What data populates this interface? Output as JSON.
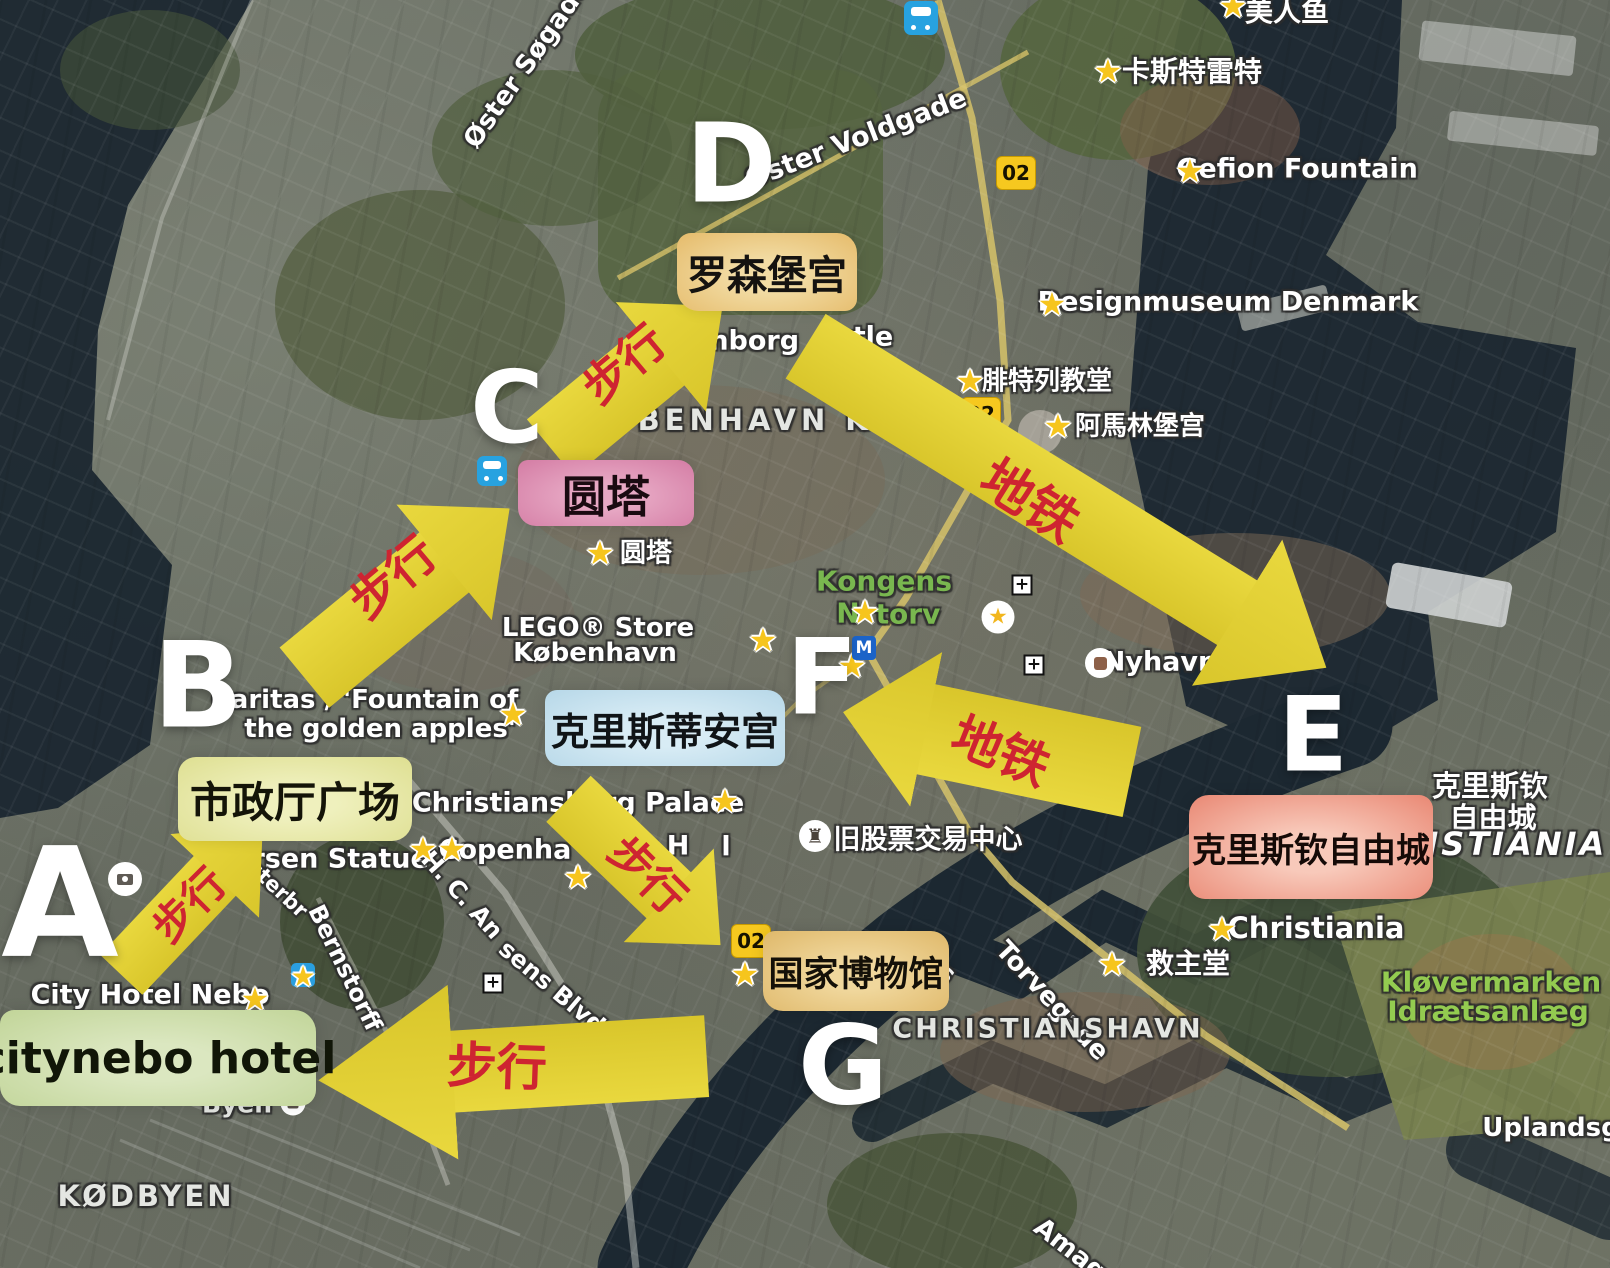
{
  "colors": {
    "arrow_yellow": "#e2cf32",
    "arrow_text_red": "#ce2431",
    "letter_white": "#ffffff",
    "map_label_green": "#79b74f",
    "park_label_green": "#93cb50",
    "water": "#1c2831",
    "star_yellow": "#f6c51d"
  },
  "letters": [
    {
      "label": "A",
      "x": 60,
      "y": 910,
      "fs": 152
    },
    {
      "label": "B",
      "x": 198,
      "y": 692,
      "fs": 119
    },
    {
      "label": "C",
      "x": 507,
      "y": 412,
      "fs": 100
    },
    {
      "label": "D",
      "x": 731,
      "y": 168,
      "fs": 110
    },
    {
      "label": "E",
      "x": 1313,
      "y": 740,
      "fs": 103
    },
    {
      "label": "F",
      "x": 822,
      "y": 682,
      "fs": 105
    },
    {
      "label": "G",
      "x": 843,
      "y": 1070,
      "fs": 110
    }
  ],
  "boxes": [
    {
      "name": "rosenborg-castle-label",
      "text": "罗森堡宫",
      "x": 767,
      "y": 272,
      "w": 180,
      "h": 78,
      "bg": "#e6bd6e",
      "bg2": "#f2dca4",
      "fg": "#151310",
      "fs": 40,
      "rad": "14px 20px 12px 22px"
    },
    {
      "name": "round-tower-label",
      "text": "圆塔",
      "x": 606,
      "y": 493,
      "w": 176,
      "h": 66,
      "bg": "#d57fa6",
      "bg2": "#e7a8c4",
      "fg": "#1a0a11",
      "fs": 44,
      "rad": "10px 16px 12px 18px"
    },
    {
      "name": "christiansborg-palace-label",
      "text": "克里斯蒂安宫",
      "x": 665,
      "y": 728,
      "w": 240,
      "h": 76,
      "bg": "#b9d9e9",
      "bg2": "#d8ecf5",
      "fg": "#101417",
      "fs": 38,
      "rad": "12px 18px 10px 16px"
    },
    {
      "name": "city-hall-square-label",
      "text": "市政厅广场",
      "x": 295,
      "y": 799,
      "w": 234,
      "h": 84,
      "bg": "#dfe094",
      "bg2": "#eff0bd",
      "fg": "#141408",
      "fs": 42,
      "rad": "18px 12px 20px 14px"
    },
    {
      "name": "citynebo-hotel-label",
      "text": "citynebo hotel",
      "x": 158,
      "y": 1058,
      "w": 316,
      "h": 96,
      "bg": "#c3d69b",
      "bg2": "#dbe7c0",
      "fg": "#111608",
      "fs": 44,
      "rad": "14px 22px 16px 20px"
    },
    {
      "name": "christiania-freetown-label",
      "text": "克里斯钦自由城",
      "x": 1311,
      "y": 847,
      "w": 244,
      "h": 104,
      "bg": "#ea8c78",
      "bg2": "#f8c9ba",
      "fg": "#150a07",
      "fs": 34,
      "rad": "20px 14px 22px 16px"
    },
    {
      "name": "national-museum-label",
      "text": "国家博物馆",
      "x": 856,
      "y": 971,
      "w": 186,
      "h": 80,
      "bg": "#e0ba6d",
      "bg2": "#f0d79c",
      "fg": "#141008",
      "fs": 35,
      "rad": "12px 18px 14px 20px"
    }
  ],
  "arrows": [
    {
      "name": "arrow-walk-a-b",
      "label": "步行",
      "cx": 192,
      "cy": 900,
      "len": 206,
      "ang": -46.6,
      "shaft": 58,
      "headL": 70,
      "headW": 122,
      "tx": 187,
      "ty": 903,
      "trot": -45,
      "tfs": 42
    },
    {
      "name": "arrow-walk-b-c",
      "label": "步行",
      "cx": 407,
      "cy": 593,
      "len": 266,
      "ang": -39.5,
      "shaft": 78,
      "headL": 85,
      "headW": 150,
      "tx": 390,
      "ty": 574,
      "trot": -40,
      "tfs": 48
    },
    {
      "name": "arrow-walk-c-d",
      "label": "步行",
      "cx": 636,
      "cy": 377,
      "len": 223,
      "ang": -39.5,
      "shaft": 74,
      "headL": 80,
      "headW": 142,
      "tx": 622,
      "ty": 362,
      "trot": -40,
      "tfs": 46
    },
    {
      "name": "arrow-metro-d-e",
      "label": "地铁",
      "cx": 1066,
      "cy": 507,
      "len": 612,
      "ang": 31.7,
      "shaft": 76,
      "headL": 105,
      "headW": 172,
      "tx": 1032,
      "ty": 497,
      "trot": 32,
      "tfs": 52
    },
    {
      "name": "arrow-metro-e-f",
      "label": "地铁",
      "cx": 987,
      "cy": 742,
      "len": 295,
      "ang": -168.3,
      "shaft": 92,
      "headL": 85,
      "headW": 158,
      "tx": 1002,
      "ty": 748,
      "trot": 22,
      "tfs": 50
    },
    {
      "name": "arrow-walk-f-g",
      "label": "步行",
      "cx": 644,
      "cy": 872,
      "len": 211,
      "ang": 43.9,
      "shaft": 64,
      "headL": 72,
      "headW": 130,
      "tx": 650,
      "ty": 872,
      "trot": 45,
      "tfs": 44
    },
    {
      "name": "arrow-walk-g-a",
      "label": "步行",
      "cx": 512,
      "cy": 1068,
      "len": 389,
      "ang": 176.5,
      "shaft": 82,
      "headL": 135,
      "headW": 175,
      "tx": 497,
      "ty": 1063,
      "trot": 2,
      "tfs": 50
    }
  ],
  "stars": [
    {
      "x": 1233,
      "y": 6
    },
    {
      "x": 1108,
      "y": 71
    },
    {
      "x": 1190,
      "y": 171
    },
    {
      "x": 1052,
      "y": 304
    },
    {
      "x": 970,
      "y": 381
    },
    {
      "x": 1058,
      "y": 426
    },
    {
      "x": 600,
      "y": 553
    },
    {
      "x": 865,
      "y": 612
    },
    {
      "x": 513,
      "y": 714
    },
    {
      "x": 725,
      "y": 801
    },
    {
      "x": 423,
      "y": 849
    },
    {
      "x": 452,
      "y": 849
    },
    {
      "x": 578,
      "y": 877
    },
    {
      "x": 763,
      "y": 640
    },
    {
      "x": 852,
      "y": 666
    },
    {
      "x": 745,
      "y": 974
    },
    {
      "x": 1112,
      "y": 964
    },
    {
      "x": 1222,
      "y": 929
    },
    {
      "x": 255,
      "y": 999
    }
  ],
  "map_texts": [
    {
      "t": "美人鱼",
      "x": 1287,
      "y": 10,
      "fs": 28
    },
    {
      "t": "卡斯特雷特",
      "x": 1192,
      "y": 70,
      "fs": 28
    },
    {
      "t": "Gefion Fountain",
      "x": 1297,
      "y": 169,
      "fs": 27
    },
    {
      "t": "Designmuseum Denmark",
      "x": 1228,
      "y": 302,
      "fs": 27
    },
    {
      "t": "腓特列教堂",
      "x": 1047,
      "y": 379,
      "fs": 26
    },
    {
      "t": "阿馬林堡宫",
      "x": 1140,
      "y": 424,
      "fs": 26
    },
    {
      "t": "Øster Søgade",
      "x": 527,
      "y": 64,
      "fs": 26,
      "rot": -55
    },
    {
      "t": "Øster Voldgade",
      "x": 856,
      "y": 139,
      "fs": 27,
      "rot": -21
    },
    {
      "t": "KØBENHAVN K",
      "x": 727,
      "y": 420,
      "fs": 29,
      "ls": 5,
      "c": "lt"
    },
    {
      "t": "senborg",
      "x": 737,
      "y": 341,
      "fs": 27
    },
    {
      "t": "tle",
      "x": 873,
      "y": 337,
      "fs": 27
    },
    {
      "t": "圆塔",
      "x": 646,
      "y": 551,
      "fs": 26
    },
    {
      "t": "LEGO® Store",
      "x": 598,
      "y": 628,
      "fs": 26
    },
    {
      "t": "København",
      "x": 595,
      "y": 653,
      "fs": 26
    },
    {
      "t": "Kongens",
      "x": 884,
      "y": 581,
      "fs": 28,
      "c": "g"
    },
    {
      "t": "N",
      "x": 848,
      "y": 613,
      "fs": 28,
      "c": "g"
    },
    {
      "t": "torv",
      "x": 908,
      "y": 614,
      "fs": 28,
      "c": "g"
    },
    {
      "t": "Nyhavn",
      "x": 1160,
      "y": 662,
      "fs": 27
    },
    {
      "t": "Caritas / 'Fountain of",
      "x": 365,
      "y": 700,
      "fs": 26
    },
    {
      "t": "the golden apples'",
      "x": 380,
      "y": 729,
      "fs": 26
    },
    {
      "t": "Christiansborg Palace",
      "x": 578,
      "y": 803,
      "fs": 27
    },
    {
      "t": "Copenha",
      "x": 505,
      "y": 850,
      "fs": 27
    },
    {
      "t": "H",
      "x": 678,
      "y": 846,
      "fs": 27
    },
    {
      "t": "l",
      "x": 726,
      "y": 847,
      "fs": 27
    },
    {
      "t": "ersen Statue",
      "x": 331,
      "y": 859,
      "fs": 27
    },
    {
      "t": "sterbr",
      "x": 278,
      "y": 889,
      "fs": 21,
      "rot": 43
    },
    {
      "t": "H. C. An",
      "x": 462,
      "y": 895,
      "fs": 24,
      "rot": 48
    },
    {
      "t": "sens Blvd",
      "x": 552,
      "y": 987,
      "fs": 24,
      "rot": 40
    },
    {
      "t": "Bernstorff",
      "x": 345,
      "y": 968,
      "fs": 24,
      "rot": 64
    },
    {
      "t": "旧股票交易中心",
      "x": 928,
      "y": 837,
      "fs": 27
    },
    {
      "t": "City Hotel Nebo",
      "x": 150,
      "y": 995,
      "fs": 27
    },
    {
      "t": "Byen",
      "x": 237,
      "y": 1104,
      "fs": 25,
      "c": "lt"
    },
    {
      "t": "KØDBYEN",
      "x": 146,
      "y": 1196,
      "fs": 29,
      "ls": 3,
      "c": "lt"
    },
    {
      "t": "s",
      "x": 947,
      "y": 973,
      "fs": 25,
      "rot": 40
    },
    {
      "t": "Torvegade",
      "x": 1052,
      "y": 1001,
      "fs": 26,
      "rot": 47
    },
    {
      "t": "CHRISTIANSHAVN",
      "x": 1048,
      "y": 1029,
      "fs": 27,
      "ls": 3,
      "c": "lt"
    },
    {
      "t": "救主堂",
      "x": 1188,
      "y": 962,
      "fs": 28
    },
    {
      "t": "Christiania",
      "x": 1316,
      "y": 928,
      "fs": 29
    },
    {
      "t": "克里斯钦",
      "x": 1490,
      "y": 784,
      "fs": 29
    },
    {
      "t": "自由城",
      "x": 1493,
      "y": 816,
      "fs": 29
    },
    {
      "t": "RISTIANIA",
      "x": 1503,
      "y": 844,
      "fs": 32,
      "ital": true,
      "ls": 3
    },
    {
      "t": "Kløvermarken",
      "x": 1491,
      "y": 982,
      "fs": 28,
      "c": "g2"
    },
    {
      "t": "Idrætsanlæg",
      "x": 1488,
      "y": 1011,
      "fs": 28,
      "c": "g2"
    },
    {
      "t": "Uplandsg",
      "x": 1551,
      "y": 1128,
      "fs": 26
    },
    {
      "t": "Amage",
      "x": 1077,
      "y": 1255,
      "fs": 26,
      "rot": 38
    }
  ],
  "icons": [
    {
      "k": "train",
      "name": "train-station-icon",
      "x": 921,
      "y": 18,
      "s": 34
    },
    {
      "k": "train",
      "name": "train-station-icon",
      "x": 492,
      "y": 471,
      "s": 30
    },
    {
      "k": "metroM",
      "name": "metro-m-icon",
      "x": 864,
      "y": 648,
      "s": 24
    },
    {
      "k": "badge02",
      "name": "route-02-badge",
      "x": 1016,
      "y": 173,
      "t": "02"
    },
    {
      "k": "badge02",
      "name": "route-02-badge",
      "x": 981,
      "y": 414,
      "t": "02"
    },
    {
      "k": "badge02",
      "name": "route-02-badge",
      "x": 751,
      "y": 941,
      "t": "02"
    },
    {
      "k": "plus",
      "name": "plus-marker-icon",
      "x": 1022,
      "y": 585
    },
    {
      "k": "plus",
      "name": "plus-marker-icon",
      "x": 1034,
      "y": 665
    },
    {
      "k": "plus",
      "name": "plus-marker-icon",
      "x": 493,
      "y": 983
    },
    {
      "k": "circleStar",
      "name": "saved-place-icon",
      "x": 998,
      "y": 617
    },
    {
      "k": "nyhavnSq",
      "name": "nyhavn-place-icon",
      "x": 1100,
      "y": 663
    },
    {
      "k": "rook",
      "name": "stock-exchange-icon",
      "x": 815,
      "y": 836
    },
    {
      "k": "camera",
      "name": "photo-spot-icon",
      "x": 125,
      "y": 879
    },
    {
      "k": "blueStar",
      "name": "transit-star-icon",
      "x": 303,
      "y": 975
    },
    {
      "k": "dot",
      "name": "dgi-byen-icon",
      "x": 293,
      "y": 1103
    }
  ]
}
